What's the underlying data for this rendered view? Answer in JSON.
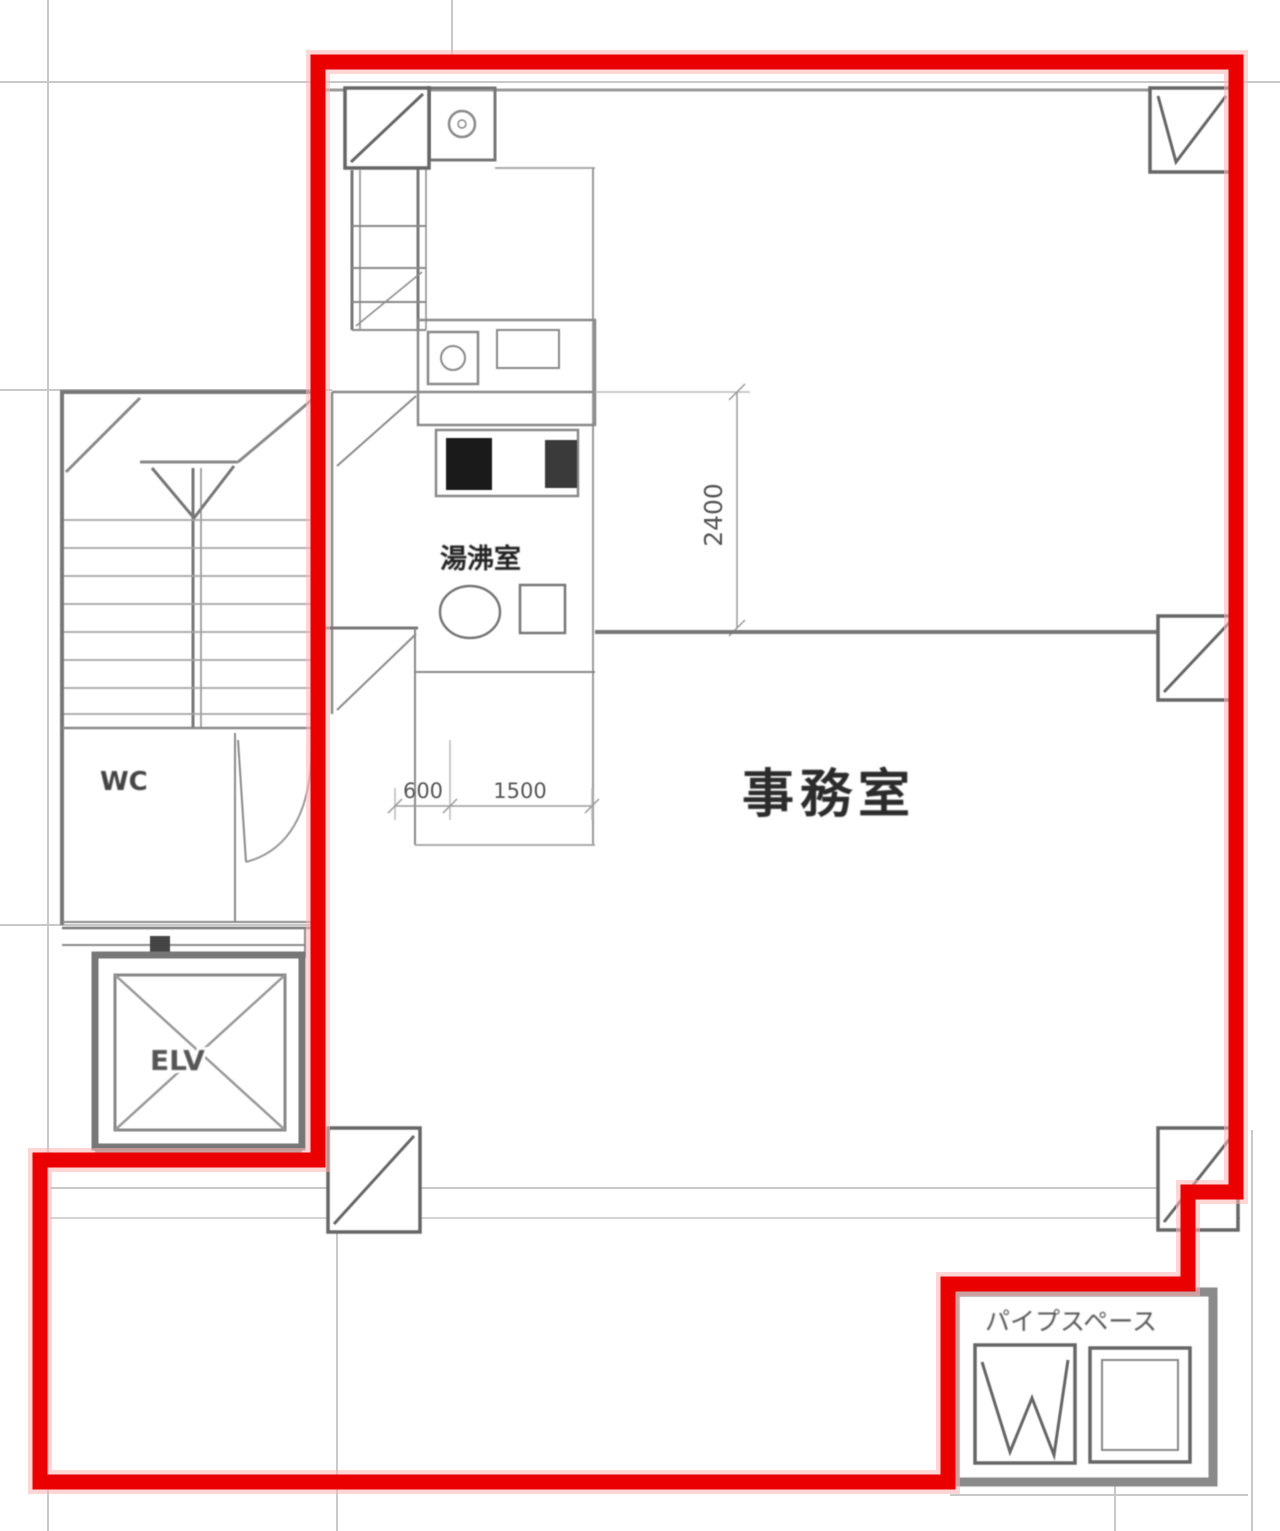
{
  "plan": {
    "type": "building-floor-plan-scan",
    "rooms": {
      "office": "事務室",
      "kitchenette": "湯沸室",
      "wc": "WC",
      "elevator": "ELV",
      "pipe_space": "パイプスペース"
    },
    "dimensions": {
      "depth": "2400",
      "width_left": "600",
      "width_right": "1500"
    },
    "colors": {
      "highlight_boundary": "#ea0000",
      "drawing_lines": "#8a8a8a",
      "grid_lines": "#c9c9c9"
    }
  }
}
